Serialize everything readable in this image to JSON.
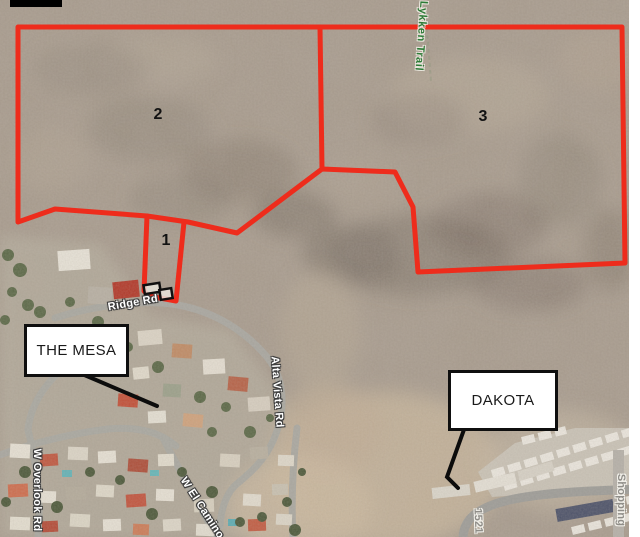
{
  "map": {
    "parcel_labels": {
      "p1": "1",
      "p2": "2",
      "p3": "3"
    },
    "callouts": {
      "mesa": "THE MESA",
      "dakota": "DAKOTA"
    },
    "road_labels": {
      "lykken_trail": "Lykken Trail",
      "ridge_rd": "Ridge Rd",
      "w_overlook_rd": "W Overlook Rd",
      "w_el_camino": "W El Camino",
      "alta_vista_rd": "Alta Vista Rd",
      "shopping": "Shopping",
      "address_1521": "1521"
    },
    "colors": {
      "parcel_outline": "#ee2c1c",
      "trail_label_green": "#2c7a36",
      "road_label_white": "#ffffff",
      "minor_label_gray": "#8f8d88",
      "callout_border": "#0f0f0f"
    }
  }
}
